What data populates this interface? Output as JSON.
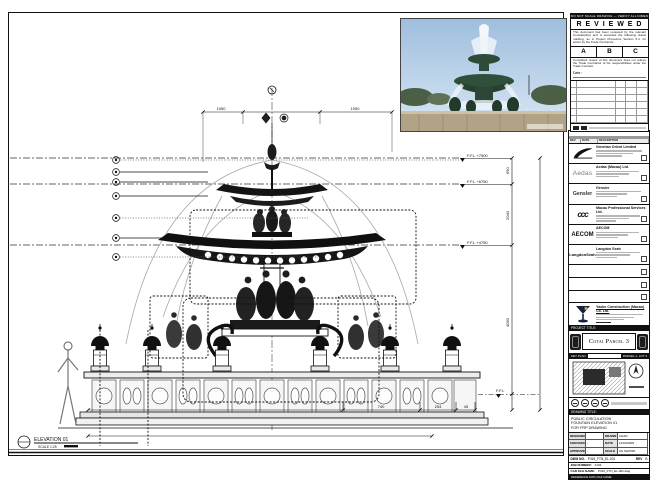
{
  "stamp": {
    "bar_note": "DO NOT SCALE DRAWING — VERIFY ALL DIMENSIONS ON SITE",
    "title": "R E V I E W E D",
    "para1": "This document has been reviewed by the relevant Consultant(s) and is accorded the following status marking, as in Project Procedure Section 5.4, for action by the Trade Contractor.",
    "grade_a": "A",
    "grade_b": "B",
    "grade_c": "C",
    "para2": "Consultant review of this document does not relieve the Trade Contractor of his responsibilities under the Trade Contract.",
    "date_label": "Date :"
  },
  "revisions": {
    "rev": "REV",
    "date": "DATE",
    "description": "DESCRIPTION"
  },
  "companies": [
    {
      "logo": "sands-swoosh",
      "name": "Venetian Orient Limited"
    },
    {
      "logo": "Aedas",
      "name": "Aedas (Macau) Ltd."
    },
    {
      "logo": "Gensler",
      "name": "Gensler"
    },
    {
      "logo": "ccc",
      "name": "Macau Professional Services Ltd."
    },
    {
      "logo": "AECOM",
      "name": "AECOM"
    },
    {
      "logo": "LangdonSeah",
      "name": "Langdon Seah"
    }
  ],
  "contractor": {
    "name": "Yaoke Construction (Macau) Co. Ltd."
  },
  "project": {
    "label": "PROJECT TITLE:",
    "title": "Cotai Parcel 3"
  },
  "keyplan": {
    "label": "KEY PLAN",
    "zone": "PARCEL 1, LOT 3"
  },
  "titleblock": {
    "drawing_title_label": "DRAWING TITLE:",
    "title_line1": "PUBLIC CIRCULATION",
    "title_line2": "FOUNTAIN ELEVATION 01",
    "title_line3": "FOR FRP DRAWING",
    "designed_label": "DESIGNED",
    "designed": "",
    "drawn_label": "DRAWN",
    "drawn": "CHAD",
    "checked_label": "CHECKED",
    "checked": "-",
    "date_label": "DATE",
    "date": "12/04/2009",
    "approved_label": "APPROVED",
    "approved": "-",
    "scale_label": "SCALE",
    "scale": "AS SHOWN",
    "dwg_no_label": "DWG NO.",
    "dwg_no": "P316_FTN_EL-001",
    "rev_label": "REV",
    "rev": "B",
    "job_label": "JOB NUMBER:",
    "job_no": "3103",
    "cad_label": "CAD FILE NAME:",
    "cad_file": "P316_FTN_EL-001.dwg",
    "ref_label": "REFERENCE DWG FILE NAME:"
  },
  "drawing": {
    "elevation_label": "ELEVATION 01",
    "scale_label": "SCALE 1:25",
    "level_1": "F.F.L +7500",
    "level_2": "F.F.L +6750",
    "level_3": "F.F.L +4750",
    "level_4": "F.F.L",
    "dim_top_left": "1050",
    "dim_top_right": "1050",
    "dim_right_1": "690",
    "dim_right_2": "2040",
    "dim_right_3": "4050",
    "dim_bottom_1": "740",
    "dim_bottom_2": "254",
    "dim_bottom_3": "45"
  }
}
